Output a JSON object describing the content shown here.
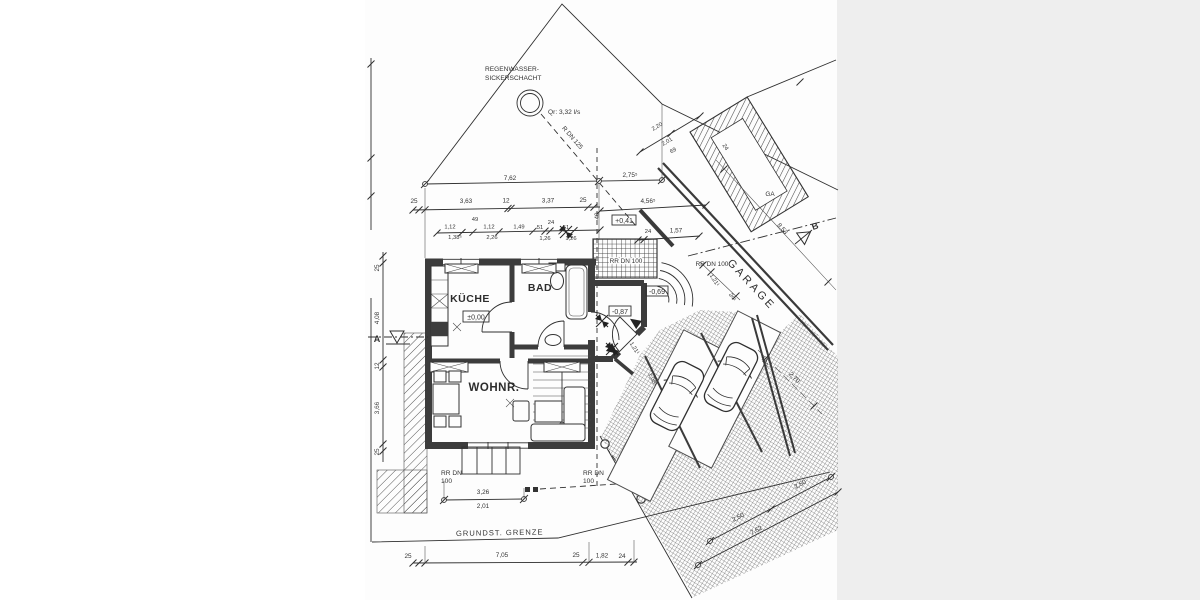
{
  "colors": {
    "paper": "#fdfdfd",
    "ink": "#333333",
    "wall": "#3c3c3c",
    "margin_right": "#eeeeee"
  },
  "site": {
    "regen1": "REGENWASSER-",
    "regen2": "SICKERSCHACHT",
    "qr": "Qr: 3,32 l/s",
    "rdn125": "R DN 125",
    "grenze": "GRUNDST. GRENZE",
    "a": "A",
    "b": "B"
  },
  "house": {
    "kueche": "KÜCHE",
    "bad": "BAD",
    "wohnr": "WOHNR.",
    "lvl0": "±0,00",
    "lvl041": "+0,41",
    "lvl069": "-0,69",
    "lvl087": "-0,87",
    "rrdn100": "RR DN 100",
    "rrdn": "RR DN",
    "r100": "100"
  },
  "garage": {
    "label": "GARAGE",
    "ga": "GA"
  },
  "dims": {
    "top762": "7,62",
    "top2755": "2,75⁵",
    "r1_25a": "25",
    "r1_363": "3,63",
    "r1_12": "12",
    "r1_337": "3,37",
    "r1_25b": "25",
    "r1_40": "40",
    "r2_112a": "1,12",
    "r2_49": "49",
    "r2_112b": "1,12",
    "r2_149": "1,49",
    "r2_51a": "51",
    "r2_24": "24",
    "r2_51b": "51",
    "r2_1385": "1,38⁵",
    "r2_226": "2,26",
    "r2_126a": "1,26",
    "r2_126b": "1,26",
    "e_24": "24",
    "e_157": "1,57",
    "e_4565": "4,56⁵",
    "ga_220": "2,20",
    "ga_201": "2,01",
    "ga_69": "69",
    "ga_24": "24",
    "ga_853": "8,53",
    "g_1211a": "1,21¹",
    "g_241": "24¹",
    "g_4991": "4,99¹",
    "g_270": "2,70",
    "g_1211b": "1,21¹",
    "g_1081": "1,08¹",
    "l_25a": "25",
    "l_408": "4,08",
    "l_12": "12",
    "l_366": "3,66",
    "l_25b": "25",
    "b_25a": "25",
    "b_705": "7,05",
    "b_25b": "25",
    "b_182": "1,82",
    "b_24": "24",
    "b_326": "3,26",
    "b_201": "2,01",
    "br_250a": "2,50",
    "br_250b": "2,50",
    "br_762": "7,62"
  }
}
